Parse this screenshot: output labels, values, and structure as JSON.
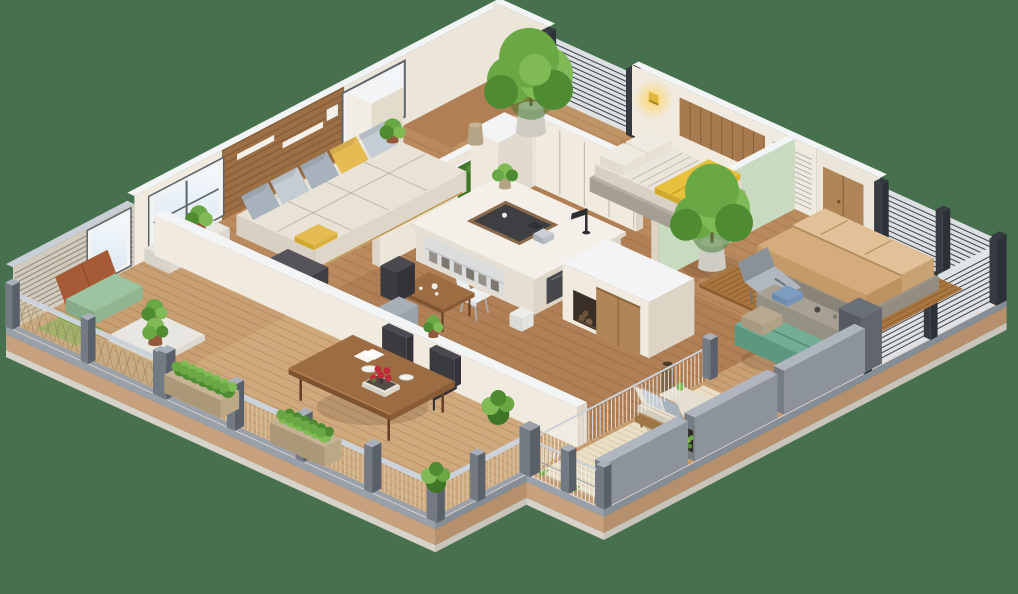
{
  "scene": {
    "description": "3D isometric floor plan render of an apartment with living room, kitchen island, two bedrooms, wrap-around balconies and terraces",
    "background": "#47714e",
    "width": 1018,
    "height": 594
  },
  "palette": {
    "bg": "#47714e",
    "fasciaGray": "#98a0aa",
    "fasciaTan": "#c7a17e",
    "fasciaLight": "#d8d3ca",
    "fasciaGrayD": "#858d97",
    "fasciaTanD": "#b6906c",
    "fasciaLightD": "#c9c4bb",
    "rim": "#e8e4dd",
    "woodBase": "#b28157",
    "woodLiving": "#ba8a5e",
    "woodKitchen": "#b07f55",
    "woodBed": "#b98a5e",
    "patioDeck": "#c09467",
    "deck": "#c89e73",
    "deckDining": "#cfa87c",
    "plankLine": "rgba(95,55,22,0.16)",
    "wallFace": "#ece5d9",
    "wallFace2": "#f0eadf",
    "wallCap": "#f2f4f6",
    "wallShade": "#ddd4c5",
    "mint": "#c8dabf",
    "accentWood": "#9c6e44",
    "accentLine": "rgba(60,35,15,0.25)",
    "shelfWhite": "#f4f1ea",
    "glassA": "#d9e6f0",
    "glassB": "#f5f9fc",
    "frame": "#f3f3f1",
    "frameDark": "#5d646d",
    "screenBase": "#d7cec0",
    "screenLine": "#6b6458",
    "screenCap": "#c9cfd7",
    "louvBase": "#e2e5e9",
    "louvLine": "#454a52",
    "louvPost": "#363b42",
    "sofa": "#e9e3d7",
    "sofaSide": "#d8d0c2",
    "seam": "rgba(120,105,85,0.35)",
    "pilGray": "#c4cdd4",
    "pilGrayD": "#a7b2bc",
    "pilYellow": "#e5bb52",
    "pilWhite": "#f0ebe1",
    "pilBeige": "#b9a88e",
    "ottoman": "#46464b",
    "ottomanT": "#54545a",
    "gold": "#c09a4b",
    "islandT": "#f4f0e9",
    "islandS": "#e5ded2",
    "islandSD": "#ddd5c8",
    "glassPanel": "rgba(210,220,228,0.55)",
    "tray": "#3d3f43",
    "trayW": "#8a6a4a",
    "lamp": "#2c2e31",
    "chairW": "#edeff0",
    "chairWS": "#dfe2e4",
    "leg": "#a9adb2",
    "appliance": "#46484c",
    "binW": "#eceee9",
    "bedBase": "#b5aea2",
    "duvet": "#ebe6dc",
    "duvetS": "#d8d1c3",
    "blanket": "#e7c13b",
    "blanketS": "#cfa92b",
    "headboard": "#a87b4f",
    "platW": "#a9763f",
    "platLine": "rgba(60,30,10,0.25)",
    "platEdge": "#8a5e32",
    "bed2base": "#9a9387",
    "bed2baseS": "#8a8478",
    "mat1": "#e2c198",
    "mat1S": "#d0ab7c",
    "mat2": "#d5ad7d",
    "mat2S": "#c39a68",
    "matSeam": "#b08a58",
    "teal": "#73ad96",
    "tealS": "#5c987f",
    "tealD": "#4d8570",
    "concrete": "#949083",
    "concreteT": "#a7a093",
    "towel": "#7c9cc0",
    "armW": "#b78d60",
    "armWD": "#9d7546",
    "cushion": "#e4dfd1",
    "rug": "#eadfc6",
    "rugLine": "#d9cbaa",
    "tableT": "#9c6c42",
    "tableS": "#7d5330",
    "tableE": "#8a5c36",
    "tableLeg": "#5f4026",
    "chairDk": "#3b3a3f",
    "chairDkT": "#4b4a50",
    "chairDkD": "#333238",
    "plate": "#f3f3ef",
    "plateEdge": "#d8d5cd",
    "flower": "#c22a3c",
    "book": "#514c45",
    "napkin": "#f6f4ee",
    "mesh": "rgba(206,184,142,0.5)",
    "meshLn": "rgba(125,108,82,0.45)",
    "railTop": "#ccd2da",
    "railMid": "#9aa1ab",
    "cable": "#dfe3e8",
    "post": "#747a84",
    "postD": "#5a606a",
    "postL": "#aab0b9",
    "baluster": "#d3bd9a",
    "wire": "#edf0f3",
    "parapet": "#8d939c",
    "parapetT": "#b0b6bf",
    "parapetD": "#767c85",
    "pillarD": "#565b63",
    "pillarT": "#6a7078",
    "pillarS": "#61666e",
    "potW": "#e8e6e0",
    "potWS": "#cfccc4",
    "potTan": "#c6b294",
    "potTanS": "#b5a386",
    "terra": "#b0714e",
    "terraD": "#92583b",
    "leafA": "#6aa845",
    "leafB": "#7fba55",
    "leafC": "#4e8b31",
    "leafD": "#3e7527",
    "trunk": "#7a5836",
    "grass": "#69a23f",
    "moss": "#7fae4a",
    "doorWood": "#b08557",
    "niche": "#3a2f26",
    "log": "#6e5238",
    "greenWall": "#3f7527",
    "lampGold": "#e3b63c",
    "glow": "#ffd257",
    "shadow": "rgba(70,45,25,0.16)",
    "slatPanel": "#eceae3",
    "slatPanelLn": "rgba(120,115,105,0.5)",
    "loungeA": "#b0b7bf",
    "loungeB": "#8a9199",
    "rust": "#a65a36",
    "sage": "#9cc4a0",
    "sageS": "#86ab88",
    "sageE": "#8fb591",
    "grayChair": "#a7afb8",
    "grayChairS": "#8f98a1",
    "grayChairE": "#9aa3ac"
  },
  "inventory": {
    "rooms": [
      {
        "id": "living-room",
        "label": "Living room"
      },
      {
        "id": "kitchen-study",
        "label": "Kitchen / study"
      },
      {
        "id": "bedroom-1",
        "label": "Bedroom with yellow blanket"
      },
      {
        "id": "bedroom-2",
        "label": "Bedroom with platform bed"
      },
      {
        "id": "dining-terrace",
        "label": "Dining terrace"
      },
      {
        "id": "armchair-terrace",
        "label": "Armchair terrace"
      },
      {
        "id": "west-balcony",
        "label": "West balcony"
      },
      {
        "id": "tree-patio",
        "label": "Tree patio"
      }
    ],
    "furniture": [
      {
        "id": "sofa",
        "label": "Cream daybed sofa with gray and yellow pillows"
      },
      {
        "id": "ottoman",
        "label": "Dark ottoman"
      },
      {
        "id": "kitchen-island",
        "label": "White island desk with tray and lamp"
      },
      {
        "id": "desk-chair",
        "label": "White desk chair"
      },
      {
        "id": "fireplace-unit",
        "label": "White media unit with log niche"
      },
      {
        "id": "nook-table",
        "label": "Small wood tea table"
      },
      {
        "id": "bed-1",
        "label": "Bed with yellow blanket"
      },
      {
        "id": "bed-2",
        "label": "Tan platform bed"
      },
      {
        "id": "lounge-chair",
        "label": "Gray lounge chair"
      },
      {
        "id": "teal-sofa",
        "label": "Teal terrace sofa"
      },
      {
        "id": "armchair",
        "label": "Wood armchair with gray pillows"
      },
      {
        "id": "dining-table",
        "label": "Wood dining table with plates and red roses"
      },
      {
        "id": "dining-chairs",
        "label": "Dark leather dining chairs"
      },
      {
        "id": "balcony-bench",
        "label": "Balcony floor seat"
      },
      {
        "id": "trees",
        "label": "Potted trees and plants"
      }
    ]
  }
}
